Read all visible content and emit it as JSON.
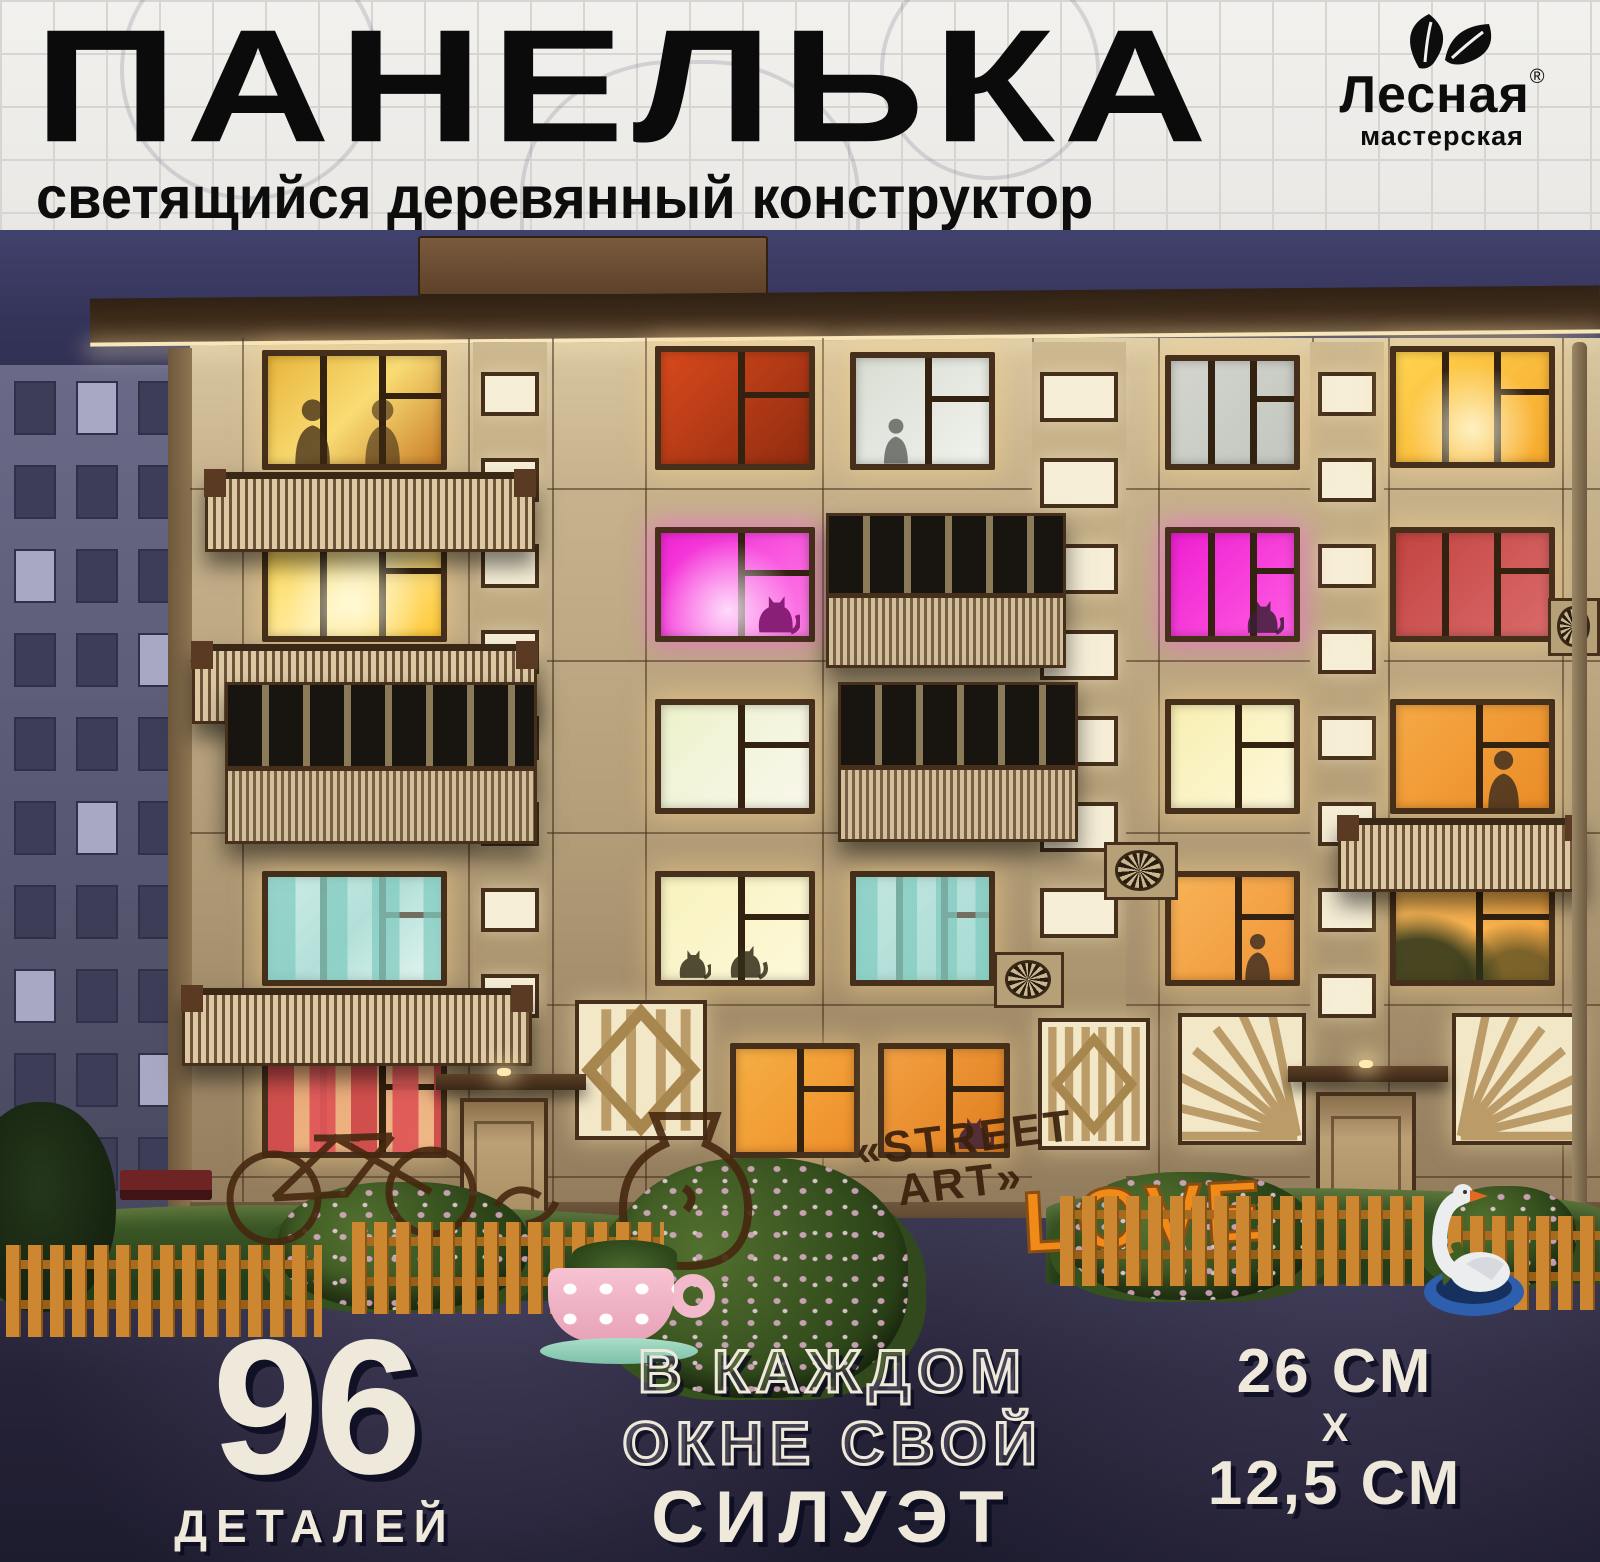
{
  "header": {
    "title": "ПАНЕЛЬКА",
    "subtitle": "светящийся деревянный конструктор",
    "logo": {
      "brand": "Лесная",
      "sub": "мастерская",
      "trademark": "®",
      "icon": "leaves-icon"
    }
  },
  "footer": {
    "parts_number": "96",
    "parts_label": "ДЕТАЛЕЙ",
    "feature_line1": "В КАЖДОМ",
    "feature_line2": "ОКНЕ СВОЙ",
    "feature_line3": "СИЛУЭТ",
    "dim_width": "26 см",
    "dim_x": "х",
    "dim_height": "12,5 см"
  },
  "scene": {
    "graffiti": {
      "street_line1": "«STREET",
      "street_line2": "ART»",
      "love": "LOVE"
    },
    "colors": {
      "sky_top": "#41416d",
      "sky_bottom": "#1e1e33",
      "facade_top": "#d9c7a1",
      "facade_mid": "#b49f7a",
      "facade_bottom": "#8f795a",
      "panel_line": "rgba(70,48,27,0.55)",
      "frame": "#46301b",
      "roof": "#3a2817",
      "roof_light": "#f7e7bd",
      "stairwell_glass": "#f6eed6",
      "balcony_light": "#dcc9a4",
      "balcony_dark": "#6d5338",
      "asphalt": "#262338",
      "grass": "#33511f",
      "fence": "#cd8730",
      "magenta": "#ee1fd0",
      "warm_yellow": "#ffd84d",
      "orange": "#f09538"
    },
    "layout": {
      "roof": {
        "x": 90,
        "y": 62,
        "w": 1510,
        "h": 48
      },
      "chimney": {
        "x": 418,
        "y": 6,
        "w": 350,
        "h": 60
      },
      "facade": {
        "x": 190,
        "y": 108,
        "w": 1410,
        "h": 902
      },
      "side_edge": {
        "x": 168,
        "y": 118,
        "w": 24,
        "h": 890
      },
      "plinth": {
        "x": 190,
        "y": 972,
        "w": 1410,
        "h": 38
      },
      "drainpipe": {
        "x": 1572,
        "y": 112,
        "w": 15,
        "h": 892
      },
      "grid_v": [
        242,
        468,
        552,
        645,
        822,
        1032,
        1158,
        1312,
        1388,
        1562
      ],
      "grid_h": [
        258,
        430,
        602,
        774,
        946
      ],
      "bg_building": {
        "x": 0,
        "y": 135,
        "w": 196,
        "h": 878,
        "rows": 10,
        "cols": 3,
        "lit_cells": [
          [
            0,
            1
          ],
          [
            2,
            0
          ],
          [
            3,
            2
          ],
          [
            5,
            1
          ],
          [
            7,
            0
          ],
          [
            8,
            2
          ]
        ]
      },
      "stairwell_strips": [
        {
          "x": 473,
          "y": 112,
          "w": 74,
          "win_w": 58,
          "win_h": 44,
          "count": 8,
          "pitch": 86,
          "start": 142
        },
        {
          "x": 1032,
          "y": 112,
          "w": 94,
          "win_w": 78,
          "win_h": 50,
          "count": 7,
          "pitch": 86,
          "start": 142
        },
        {
          "x": 1310,
          "y": 112,
          "w": 74,
          "win_w": 58,
          "win_h": 44,
          "count": 8,
          "pitch": 86,
          "start": 142
        }
      ],
      "windows": [
        {
          "x": 262,
          "y": 120,
          "w": 185,
          "h": 120,
          "panes": 3,
          "colors": [
            "#e8b53a",
            "#f9dc74",
            "#c97f28"
          ],
          "overlay": "figures"
        },
        {
          "x": 262,
          "y": 297,
          "w": 185,
          "h": 115,
          "panes": 3,
          "colors": [
            "#ffd84d",
            "#ffeca6",
            "#ffc832"
          ],
          "overlay": "glow"
        },
        {
          "x": 262,
          "y": 641,
          "w": 185,
          "h": 115,
          "panes": 3,
          "colors": [
            "#c2e6e0",
            "#93d2c9",
            "#e2f2ec"
          ],
          "overlay": "curtains-cyan"
        },
        {
          "x": 262,
          "y": 813,
          "w": 185,
          "h": 115,
          "panes": 3,
          "colors": [
            "#e9a876",
            "#f0b888"
          ],
          "overlay": "curtains-red"
        },
        {
          "x": 655,
          "y": 116,
          "w": 160,
          "h": 124,
          "panes": 2,
          "colors": [
            "#d8491c",
            "#902c10"
          ]
        },
        {
          "x": 655,
          "y": 297,
          "w": 160,
          "h": 115,
          "panes": 2,
          "colors": [
            "#f224d4",
            "#ff80e8"
          ],
          "overlay": "pinkglow"
        },
        {
          "x": 655,
          "y": 469,
          "w": 160,
          "h": 115,
          "panes": 2,
          "colors": [
            "#edf2cb",
            "#f9f7ec"
          ]
        },
        {
          "x": 655,
          "y": 641,
          "w": 160,
          "h": 115,
          "panes": 2,
          "colors": [
            "#f8f2bd",
            "#fdf9da"
          ],
          "overlay": "cats"
        },
        {
          "x": 730,
          "y": 813,
          "w": 130,
          "h": 115,
          "panes": 2,
          "colors": [
            "#f5ae43",
            "#ef8f2b"
          ]
        },
        {
          "x": 850,
          "y": 122,
          "w": 145,
          "h": 118,
          "panes": 2,
          "colors": [
            "#d9ddd3",
            "#f0f2ec"
          ],
          "overlay": "figure"
        },
        {
          "x": 850,
          "y": 641,
          "w": 145,
          "h": 115,
          "panes": 3,
          "colors": [
            "#aedcd4",
            "#82cac0"
          ],
          "overlay": "curtains-cyan"
        },
        {
          "x": 878,
          "y": 813,
          "w": 132,
          "h": 115,
          "panes": 2,
          "colors": [
            "#f2a143",
            "#e07d1d"
          ],
          "overlay": "cat"
        },
        {
          "x": 1165,
          "y": 125,
          "w": 135,
          "h": 115,
          "panes": 3,
          "colors": [
            "#d4d6ce",
            "#c2c6be"
          ]
        },
        {
          "x": 1165,
          "y": 297,
          "w": 135,
          "h": 115,
          "panes": 3,
          "colors": [
            "#ee1fd0",
            "#ff5ce2"
          ],
          "overlay": "cat"
        },
        {
          "x": 1165,
          "y": 469,
          "w": 135,
          "h": 115,
          "panes": 2,
          "colors": [
            "#f8efb2",
            "#fdf7d9"
          ]
        },
        {
          "x": 1165,
          "y": 641,
          "w": 135,
          "h": 115,
          "panes": 2,
          "colors": [
            "#f8b357",
            "#f09538"
          ],
          "overlay": "person"
        },
        {
          "x": 1390,
          "y": 116,
          "w": 165,
          "h": 122,
          "panes": 3,
          "colors": [
            "#ffd44f",
            "#f7a92d"
          ],
          "overlay": "glow"
        },
        {
          "x": 1390,
          "y": 297,
          "w": 165,
          "h": 115,
          "panes": 3,
          "colors": [
            "#c24440",
            "#da6a6a"
          ]
        },
        {
          "x": 1390,
          "y": 469,
          "w": 165,
          "h": 115,
          "panes": 2,
          "colors": [
            "#f6a945",
            "#ea8c26"
          ],
          "overlay": "person"
        },
        {
          "x": 1390,
          "y": 641,
          "w": 165,
          "h": 115,
          "panes": 2,
          "colors": [
            "#ffc05e",
            "#f9a73e"
          ],
          "overlay": "plant"
        }
      ],
      "balconies_open": [
        {
          "x": 205,
          "y": 242,
          "w": 330,
          "h": 80
        },
        {
          "x": 192,
          "y": 414,
          "w": 345,
          "h": 80
        },
        {
          "x": 182,
          "y": 758,
          "w": 350,
          "h": 78
        },
        {
          "x": 1338,
          "y": 588,
          "w": 248,
          "h": 74
        }
      ],
      "balconies_glazed": [
        {
          "x": 225,
          "y": 452,
          "w": 312,
          "h": 162
        },
        {
          "x": 826,
          "y": 283,
          "w": 240,
          "h": 155
        },
        {
          "x": 838,
          "y": 452,
          "w": 240,
          "h": 160
        }
      ],
      "screens": [
        {
          "type": "diamond",
          "x": 575,
          "y": 770,
          "w": 132,
          "h": 140
        },
        {
          "type": "bars",
          "x": 1038,
          "y": 788,
          "w": 112,
          "h": 132
        },
        {
          "type": "sunburst",
          "origin": "br",
          "x": 1178,
          "y": 783,
          "w": 128,
          "h": 132
        },
        {
          "type": "sunburst",
          "origin": "bl",
          "x": 1452,
          "y": 783,
          "w": 128,
          "h": 132
        }
      ],
      "doors": [
        {
          "x": 460,
          "y": 868,
          "w": 88,
          "h": 142,
          "canopy": {
            "x": 436,
            "y": 844,
            "w": 150,
            "h": 16
          }
        },
        {
          "x": 1316,
          "y": 862,
          "w": 100,
          "h": 148,
          "canopy": {
            "x": 1288,
            "y": 836,
            "w": 160,
            "h": 16
          }
        }
      ],
      "fans": [
        {
          "x": 1104,
          "y": 612,
          "w": 74,
          "h": 58
        },
        {
          "x": 994,
          "y": 722,
          "w": 70,
          "h": 56
        },
        {
          "x": 1548,
          "y": 368,
          "w": 52,
          "h": 58
        }
      ],
      "asphalt": {
        "x": 0,
        "y": 988,
        "w": 1600,
        "h": 344
      },
      "grass": [
        {
          "x": 0,
          "y": 975,
          "w": 680,
          "h": 96
        },
        {
          "x": 1046,
          "y": 958,
          "w": 554,
          "h": 96
        }
      ],
      "fences": [
        {
          "x": 6,
          "y": 1015,
          "w": 316,
          "h": 92
        },
        {
          "x": 352,
          "y": 992,
          "w": 312,
          "h": 92
        },
        {
          "x": 1060,
          "y": 966,
          "w": 364,
          "h": 90
        },
        {
          "x": 1448,
          "y": 986,
          "w": 152,
          "h": 94
        }
      ],
      "bushes": [
        {
          "x": 278,
          "y": 952,
          "w": 250,
          "h": 128
        },
        {
          "x": 608,
          "y": 928,
          "w": 300,
          "h": 240
        },
        {
          "x": 1066,
          "y": 942,
          "w": 248,
          "h": 128
        },
        {
          "x": 1436,
          "y": 956,
          "w": 140,
          "h": 100
        }
      ],
      "tree": {
        "x": -34,
        "y": 872,
        "w": 150,
        "h": 210
      },
      "bench": {
        "x": 120,
        "y": 940,
        "w": 92,
        "h": 30
      },
      "teacup": {
        "x": 540,
        "y": 1016,
        "w": 175,
        "h": 130
      },
      "swan": {
        "x": 1414,
        "y": 930,
        "w": 120,
        "h": 160
      },
      "bike_graffiti": {
        "x": 196,
        "y": 856,
        "w": 420,
        "h": 165
      },
      "jug_graffiti": {
        "x": 592,
        "y": 872,
        "w": 190,
        "h": 175
      },
      "street_art": {
        "x": 858,
        "y": 888,
        "w": 200
      },
      "love": {
        "x": 1022,
        "y": 938
      },
      "f96": {
        "x": 120,
        "y": 1098,
        "w": 390
      },
      "feature": {
        "x": 508,
        "y": 1106,
        "w": 650
      },
      "dims": {
        "x": 1140,
        "y": 1108,
        "w": 390
      }
    }
  }
}
